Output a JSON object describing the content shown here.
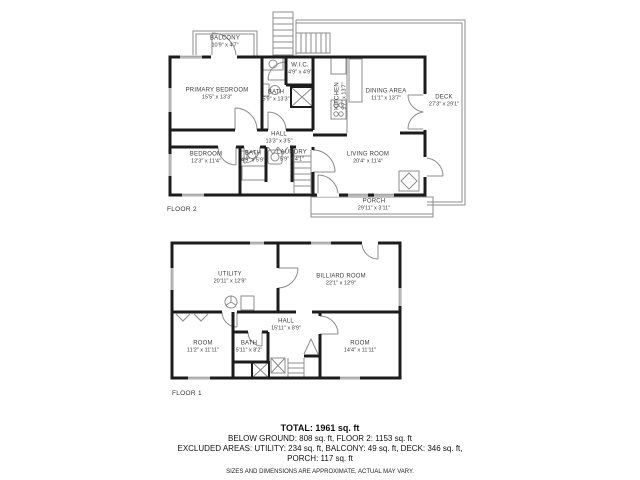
{
  "palette": {
    "wall": "#1c1c1c",
    "thin": "#8c8c8c",
    "label": "#3d3d3d",
    "background": "#ffffff"
  },
  "floor2": {
    "label": "FLOOR 2",
    "rooms": {
      "balcony": {
        "name": "BALCONY",
        "dims": "10'9\" x 4'7\""
      },
      "primary_bedroom": {
        "name": "PRIMARY BEDROOM",
        "dims": "15'5\" x 13'3\""
      },
      "wic": {
        "name": "W.I.C.",
        "dims": "4'9\" x 4'9\""
      },
      "bath_upper": {
        "name": "BATH",
        "dims": "5'9\" x 13'3\""
      },
      "kitchen": {
        "name": "KITCHEN",
        "dims": "9'7\" x 13'7\""
      },
      "dining": {
        "name": "DINING AREA",
        "dims": "11'1\" x 13'7\""
      },
      "hall": {
        "name": "HALL",
        "dims": "13'3\" x 3'5\""
      },
      "bedroom": {
        "name": "BEDROOM",
        "dims": "12'3\" x 11'4\""
      },
      "bath_small": {
        "name": "BATH",
        "dims": "4'9\" x 5'9\""
      },
      "laundry": {
        "name": "LAUNDRY",
        "dims": "5'9\" x 4'1\""
      },
      "living": {
        "name": "LIVING ROOM",
        "dims": "20'4\" x 11'4\""
      },
      "deck": {
        "name": "DECK",
        "dims": "27'3\" x 29'1\""
      },
      "porch": {
        "name": "PORCH",
        "dims": "29'11\" x 3'11\""
      }
    }
  },
  "floor1": {
    "label": "FLOOR 1",
    "rooms": {
      "utility": {
        "name": "UTILITY",
        "dims": "20'11\" x 12'9\""
      },
      "billiard": {
        "name": "BILLIARD ROOM",
        "dims": "22'1\" x 12'9\""
      },
      "hall": {
        "name": "HALL",
        "dims": "15'11\" x 8'9\""
      },
      "room_left": {
        "name": "ROOM",
        "dims": "11'2\" x 11'11\""
      },
      "bath": {
        "name": "BATH",
        "dims": "5'11\" x 8'2\""
      },
      "room_right": {
        "name": "ROOM",
        "dims": "14'4\" x 11'11\""
      }
    }
  },
  "summary": {
    "total": "TOTAL: 1961 sq. ft",
    "below": "BELOW GROUND: 808 sq. ft, FLOOR 2: 1153 sq. ft",
    "excluded1": "EXCLUDED AREAS: UTILITY: 234 sq. ft, BALCONY: 49 sq. ft, DECK: 346 sq. ft,",
    "excluded2": "PORCH: 117 sq. ft",
    "disclaimer": "SIZES AND DIMENSIONS ARE APPROXIMATE, ACTUAL MAY VARY."
  }
}
